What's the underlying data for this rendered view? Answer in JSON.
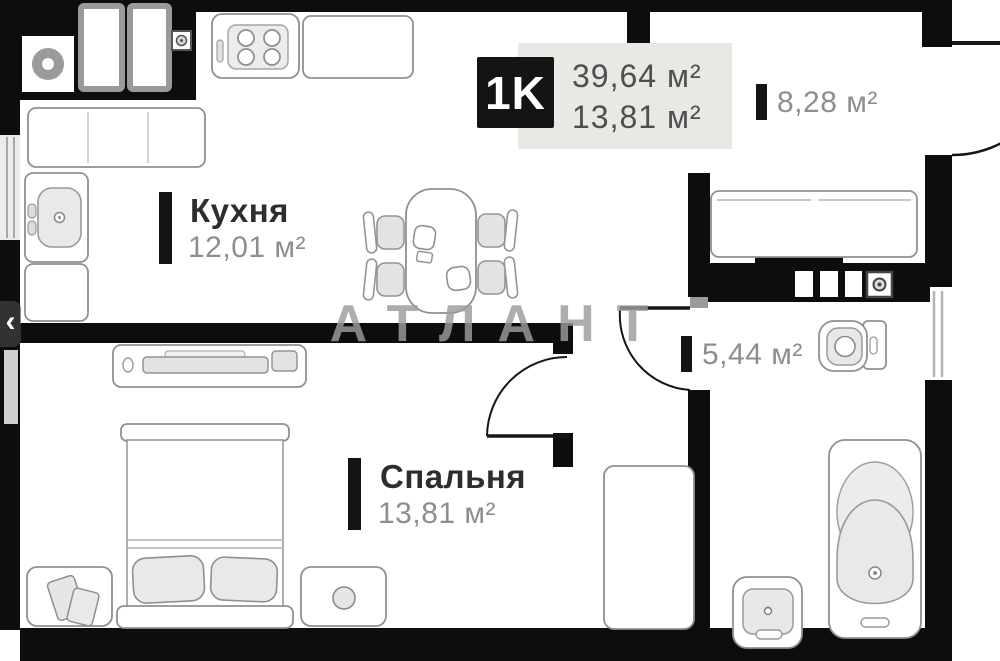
{
  "badge": {
    "type_label": "1K",
    "total_area": "39,64 м²",
    "living_area": "13,81 м²"
  },
  "rooms": {
    "kitchen": {
      "name": "Кухня",
      "area": "12,01 м²"
    },
    "bedroom": {
      "name": "Спальня",
      "area": "13,81 м²"
    },
    "hallway": {
      "area": "8,28 м²"
    },
    "bathroom": {
      "area": "5,44 м²"
    }
  },
  "watermark": {
    "text": "АТЛАНТ"
  },
  "carousel": {
    "prev_icon": "‹"
  },
  "colors": {
    "wall": "#0d0d0d",
    "badge_bg": "#141414",
    "panel_bg": "#e9e8e5",
    "room_name_text": "#2d2d2d",
    "area_text": "#8e8e8e",
    "watermark_text": "#9c9c9c",
    "furniture_stroke": "#909090",
    "furniture_fill": "#e7e7e7"
  }
}
